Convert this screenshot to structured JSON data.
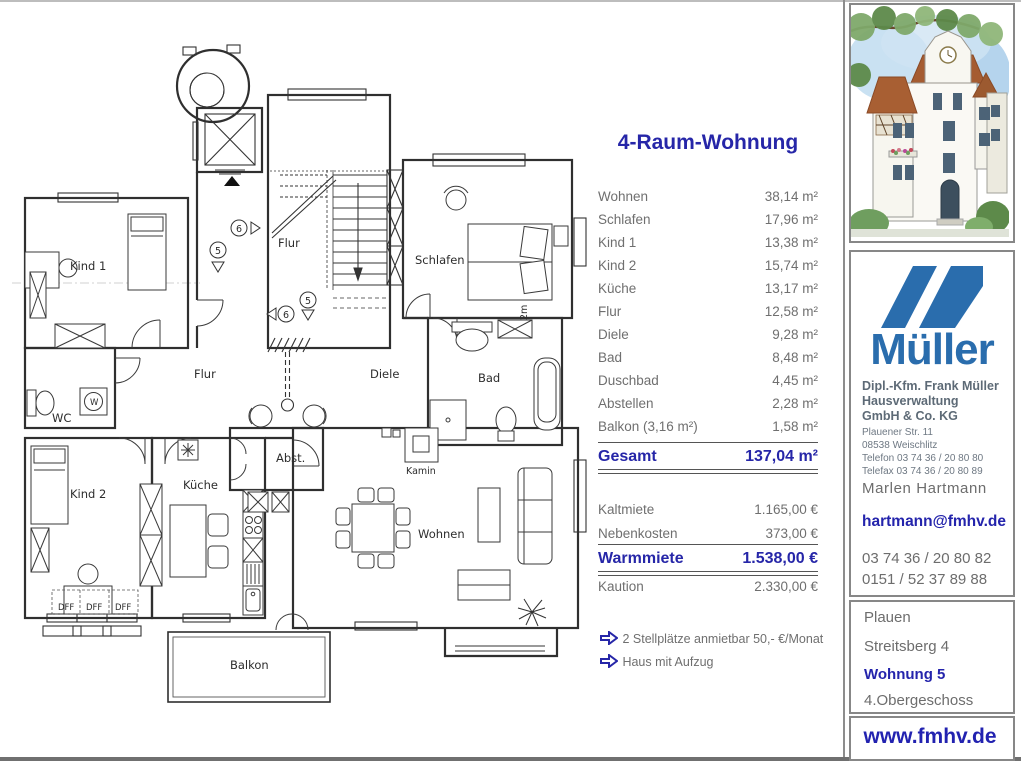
{
  "title": "4-Raum-Wohnung",
  "rooms": [
    {
      "label": "Wohnen",
      "value": "38,14 m²"
    },
    {
      "label": "Schlafen",
      "value": "17,96 m²"
    },
    {
      "label": "Kind 1",
      "value": "13,38 m²"
    },
    {
      "label": "Kind 2",
      "value": "15,74 m²"
    },
    {
      "label": "Küche",
      "value": "13,17 m²"
    },
    {
      "label": "Flur",
      "value": "12,58 m²"
    },
    {
      "label": "Diele",
      "value": "9,28 m²"
    },
    {
      "label": "Bad",
      "value": "8,48 m²"
    },
    {
      "label": "Duschbad",
      "value": "4,45 m²"
    },
    {
      "label": "Abstellen",
      "value": "2,28 m²"
    },
    {
      "label": "Balkon (3,16 m²)",
      "value": "1,58 m²"
    }
  ],
  "total": {
    "label": "Gesamt",
    "value": "137,04 m²"
  },
  "costs": [
    {
      "label": "Kaltmiete",
      "value": "1.165,00 €"
    },
    {
      "label": "Nebenkosten",
      "value": "373,00 €"
    }
  ],
  "warm": {
    "label": "Warmmiete",
    "value": "1.538,00 €"
  },
  "deposit": {
    "label": "Kaution",
    "value": "2.330,00 €"
  },
  "notes": [
    {
      "text": "2 Stellplätze anmietbar 50,- €/Monat"
    },
    {
      "text": "Haus mit Aufzug"
    }
  ],
  "floorplan": {
    "stair_hall": "Flur",
    "kind1": "Kind 1",
    "schlafen": "Schlafen",
    "wc": "WC",
    "w_machine": "W",
    "hall": "Flur",
    "diele": "Diele",
    "bad": "Bad",
    "kind2": "Kind 2",
    "kueche": "Küche",
    "abst": "Abst.",
    "kamin": "Kamin",
    "wohnen": "Wohnen",
    "balkon": "Balkon",
    "dff": "DFF",
    "two_m": "2m",
    "marker5": "5",
    "marker6": "6"
  },
  "sidebar": {
    "logo_text": "Müller",
    "company": [
      "Dipl.-Kfm. Frank Müller",
      "Hausverwaltung",
      "GmbH & Co. KG"
    ],
    "details": [
      "Plauener Str. 11",
      "08538 Weischlitz",
      "Telefon  03 74 36 / 20 80 80",
      "Telefax 03 74 36 / 20 80 89"
    ],
    "contact_name": "Marlen Hartmann",
    "email": "hartmann@fmhv.de",
    "phones": [
      "03 74 36 / 20 80 82",
      "0151 / 52 37 89 88"
    ],
    "address": {
      "city": "Plauen",
      "street": "Streitsberg 4",
      "unit": "Wohnung 5",
      "floor": "4.Obergeschoss"
    },
    "website": "www.fmhv.de"
  },
  "colors": {
    "navy": "#2626a8",
    "logo_blue": "#2a6dad",
    "text_gray": "#6f6f6f"
  }
}
